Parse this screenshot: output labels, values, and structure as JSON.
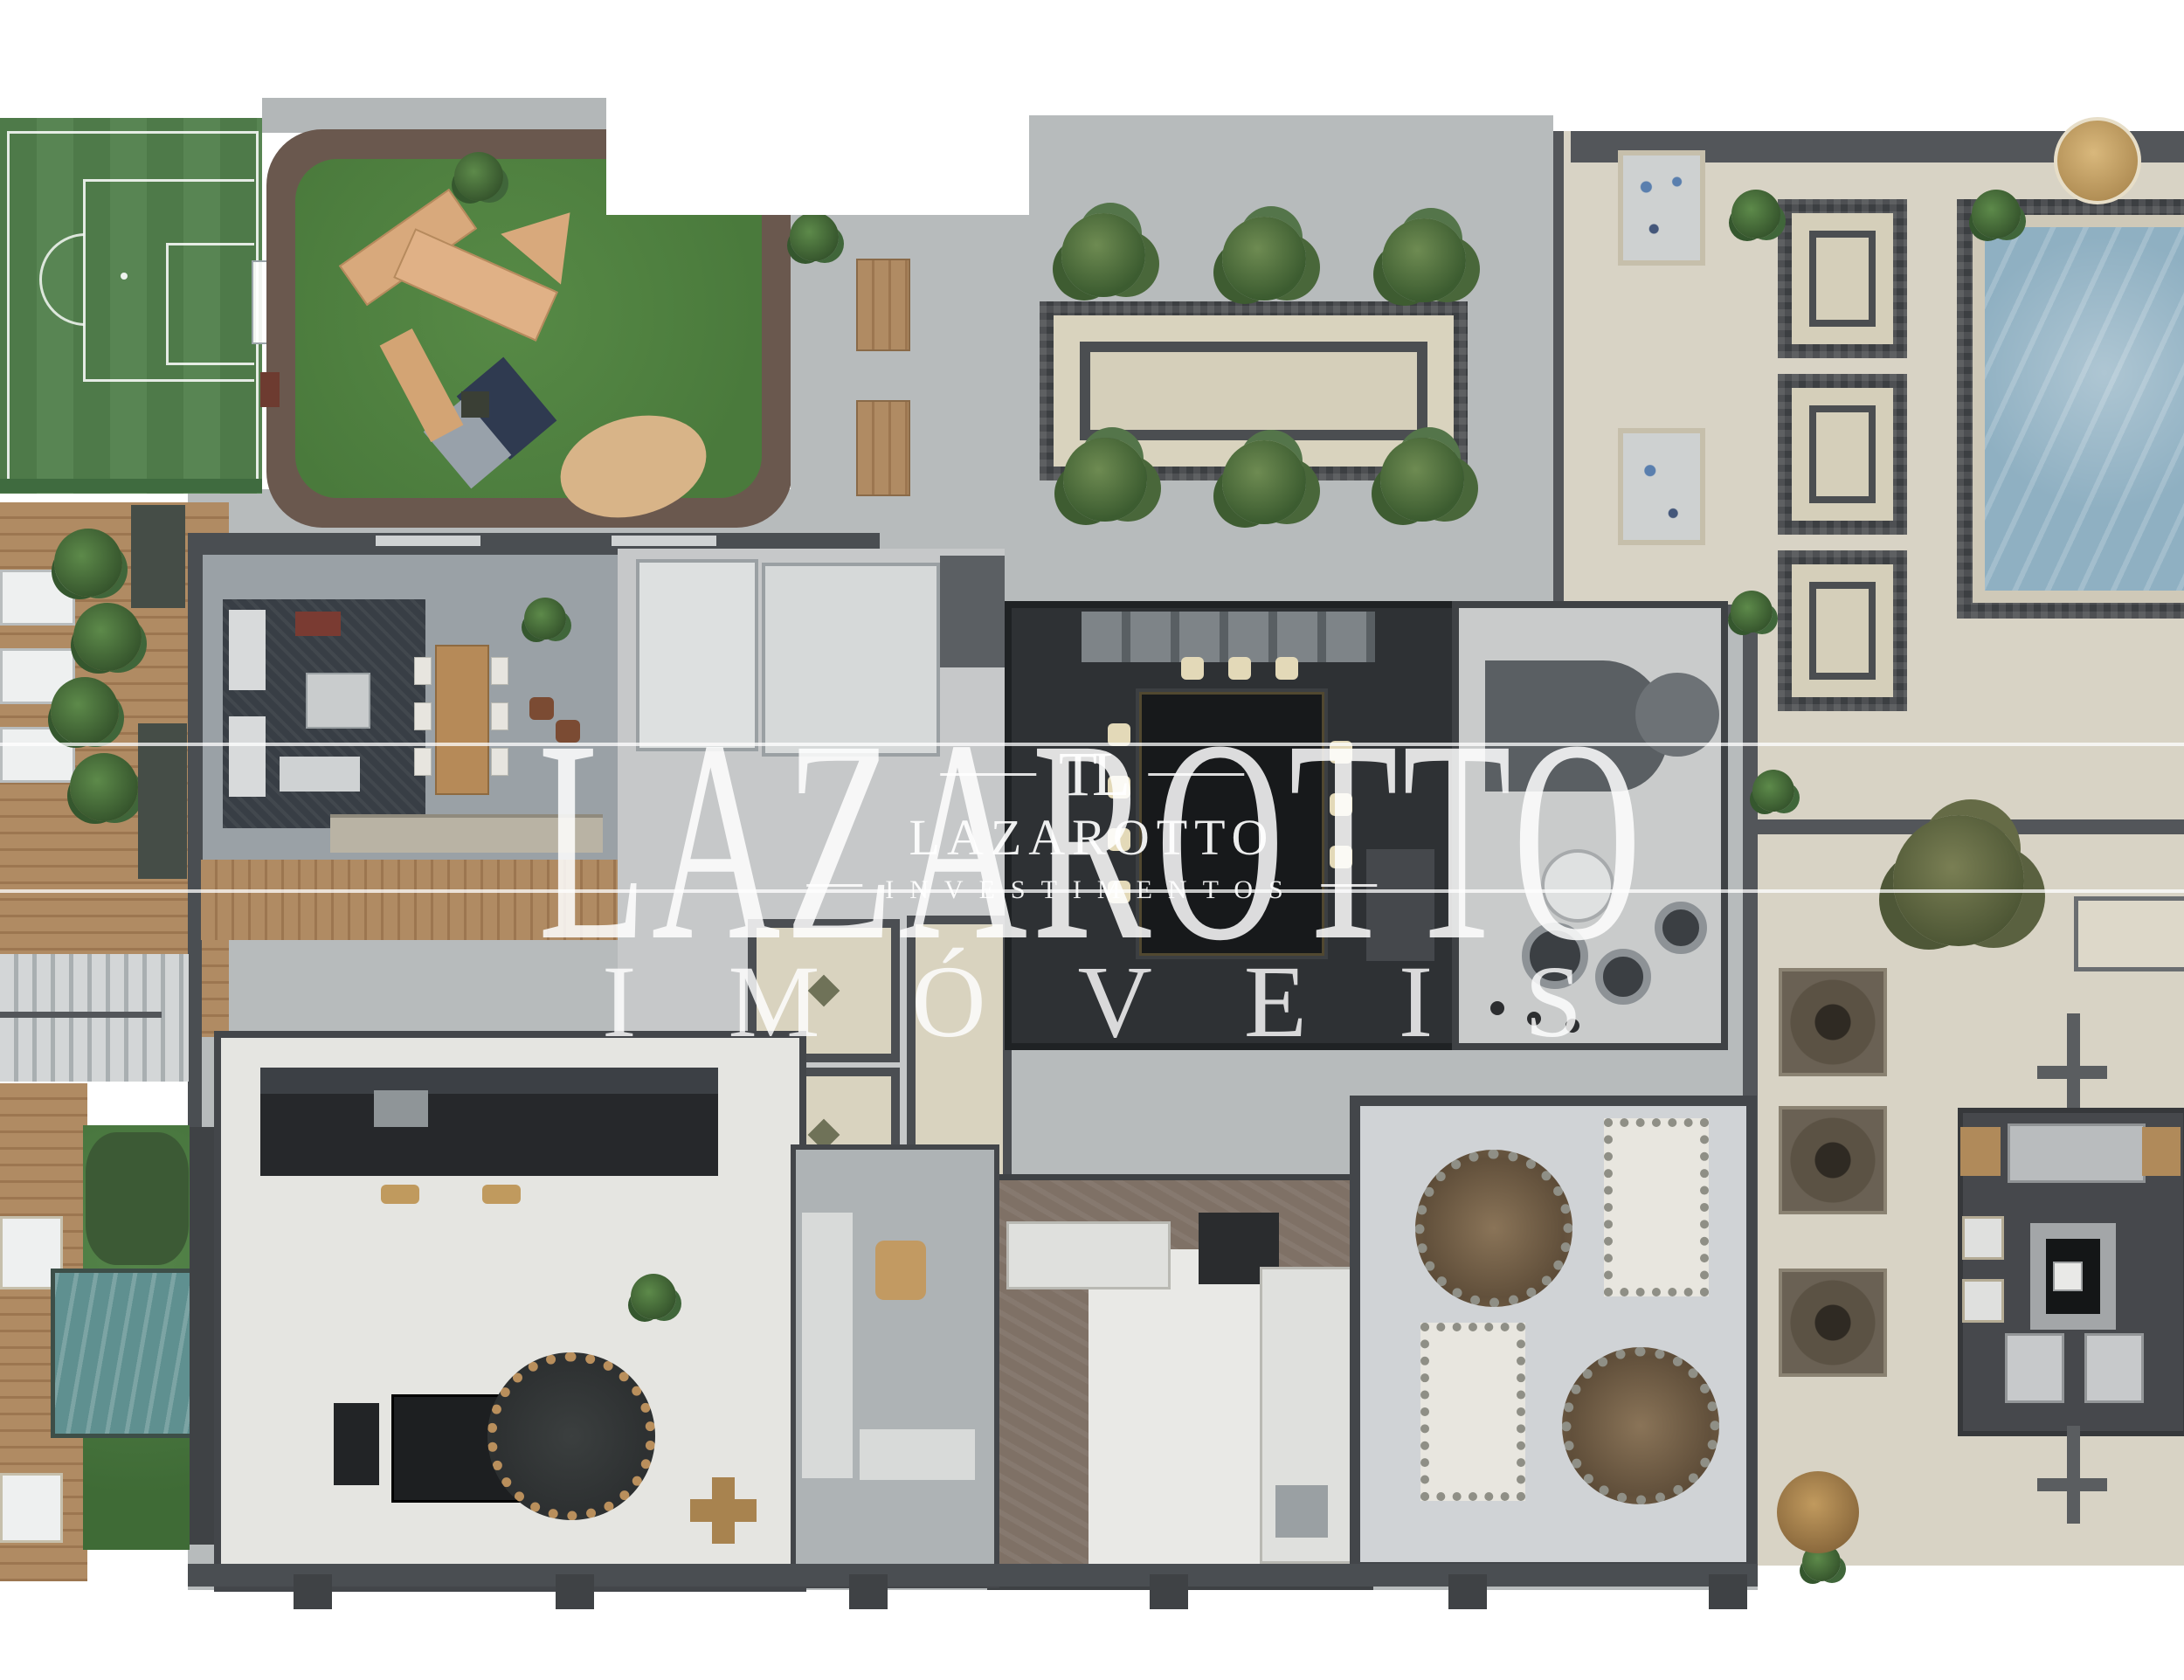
{
  "watermark": {
    "brand_large": "LAZAROTTO",
    "brand_sub": "IMÓVEIS",
    "logo": {
      "monogram": "TL",
      "name": "LAZAROTTO",
      "tagline": "INVESTIMENTOS"
    }
  },
  "palette": {
    "field_green": "#4e7a49",
    "playground_rubber": "#6a584e",
    "playground_grass": "#4f8040",
    "paving_grey": "#b7bbbc",
    "deck_beige": "#d8d3c5",
    "wood": "#b08b63",
    "pool_water": "#8fb0c2",
    "plunge_pool": "#5f9090",
    "dark_marble": "#2e3134",
    "room_grey": "#9aa1a6",
    "room_light": "#ced1d3",
    "white_floor": "#e9e9e6",
    "brown_marble": "#7f7166",
    "wall": "#4e5357",
    "tree_green": "#3e6b34",
    "accent_tan": "#c09a5e",
    "watermark_white": "#ffffff"
  }
}
